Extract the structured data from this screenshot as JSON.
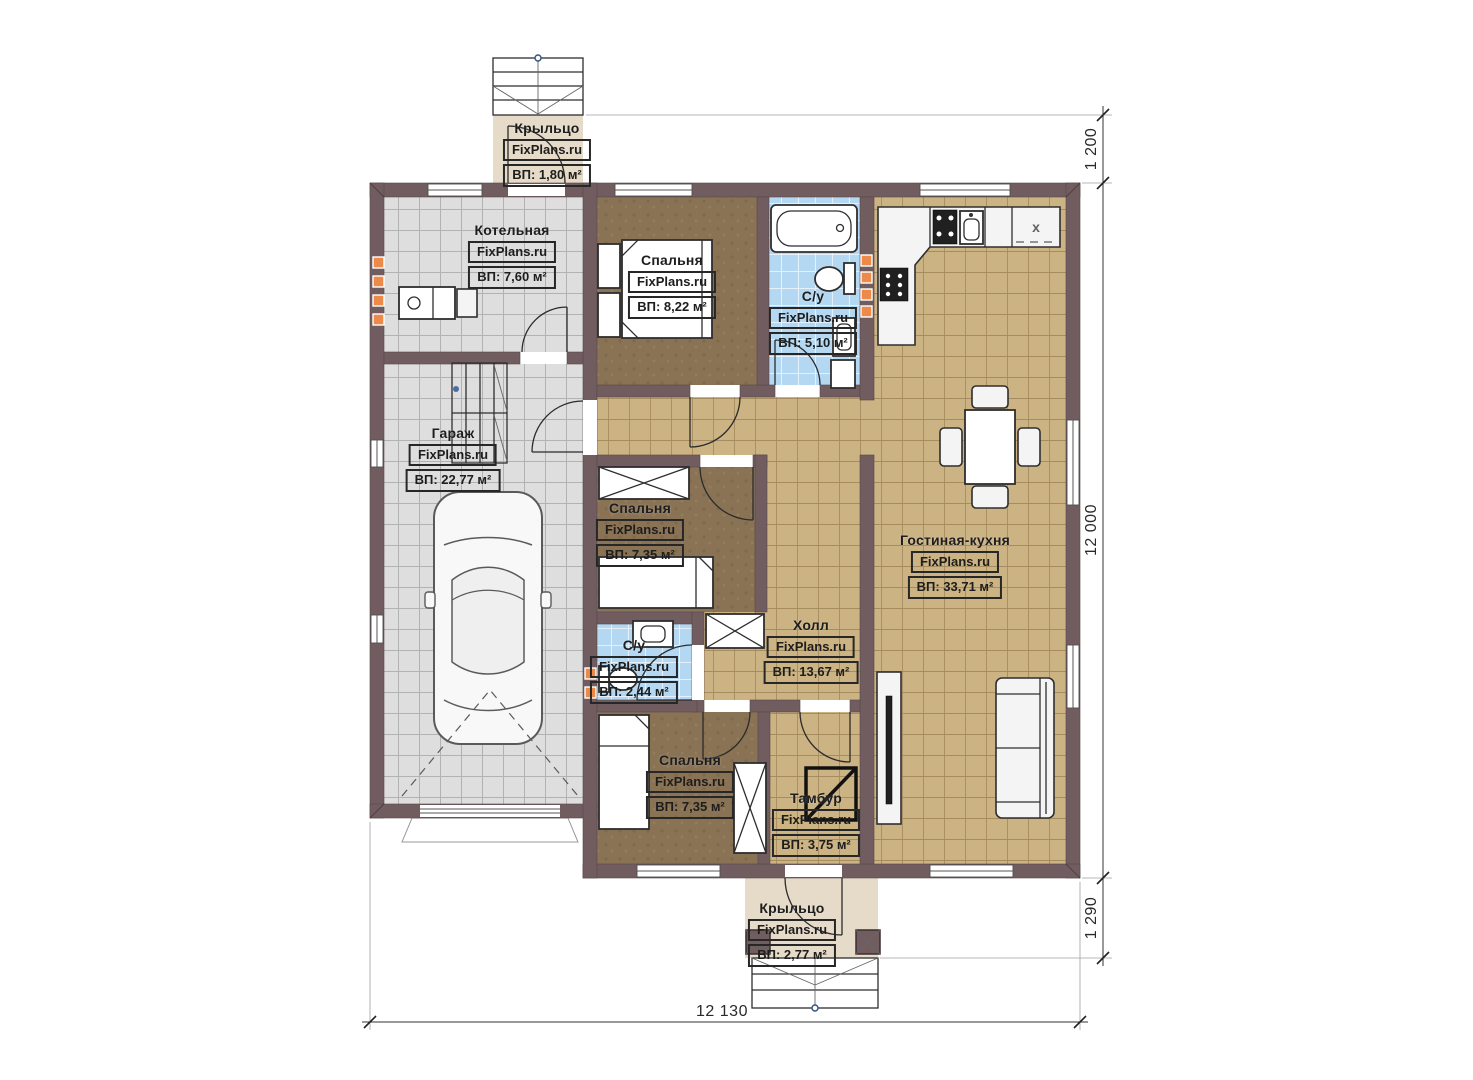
{
  "rooms": {
    "porch_top": {
      "name": "Крыльцо",
      "brand": "FixPlans.ru",
      "area": "ВП: 1,80 м²"
    },
    "boiler": {
      "name": "Котельная",
      "brand": "FixPlans.ru",
      "area": "ВП: 7,60 м²"
    },
    "bedroom1": {
      "name": "Спальня",
      "brand": "FixPlans.ru",
      "area": "ВП: 8,22 м²"
    },
    "bath1": {
      "name": "С/у",
      "brand": "FixPlans.ru",
      "area": "ВП: 5,10 м²"
    },
    "garage": {
      "name": "Гараж",
      "brand": "FixPlans.ru",
      "area": "ВП: 22,77 м²"
    },
    "bedroom2": {
      "name": "Спальня",
      "brand": "FixPlans.ru",
      "area": "ВП: 7,35 м²"
    },
    "living_kitchen": {
      "name": "Гостиная-кухня",
      "brand": "FixPlans.ru",
      "area": "ВП: 33,71 м²"
    },
    "hall": {
      "name": "Холл",
      "brand": "FixPlans.ru",
      "area": "ВП: 13,67 м²"
    },
    "bath2": {
      "name": "С/у",
      "brand": "FixPlans.ru",
      "area": "ВП: 2,44 м²"
    },
    "bedroom3": {
      "name": "Спальня",
      "brand": "FixPlans.ru",
      "area": "ВП: 7,35 м²"
    },
    "vestibule": {
      "name": "Тамбур",
      "brand": "FixPlans.ru",
      "area": "ВП: 3,75 м²"
    },
    "porch_bottom": {
      "name": "Крыльцо",
      "brand": "FixPlans.ru",
      "area": "ВП: 2,77 м²"
    }
  },
  "dimensions": {
    "top_right": "1 200",
    "right_side": "12 000",
    "bottom_right": "1 290",
    "bottom": "12 130"
  },
  "kitchen": {
    "fridge_mark": "x"
  },
  "colors": {
    "wall": "#715d5f",
    "tile_gray": "#dedede",
    "tile_gray_ln": "#b2b2b2",
    "tile_tan": "#ccb383",
    "tile_tan_ln": "#a68c5e",
    "tile_blue": "#b5d8f2",
    "tile_blue_ln": "#e4f1fc",
    "floor_brown": "#8a7355",
    "porch": "#e6dbc8",
    "vent": "#ee8a49"
  }
}
